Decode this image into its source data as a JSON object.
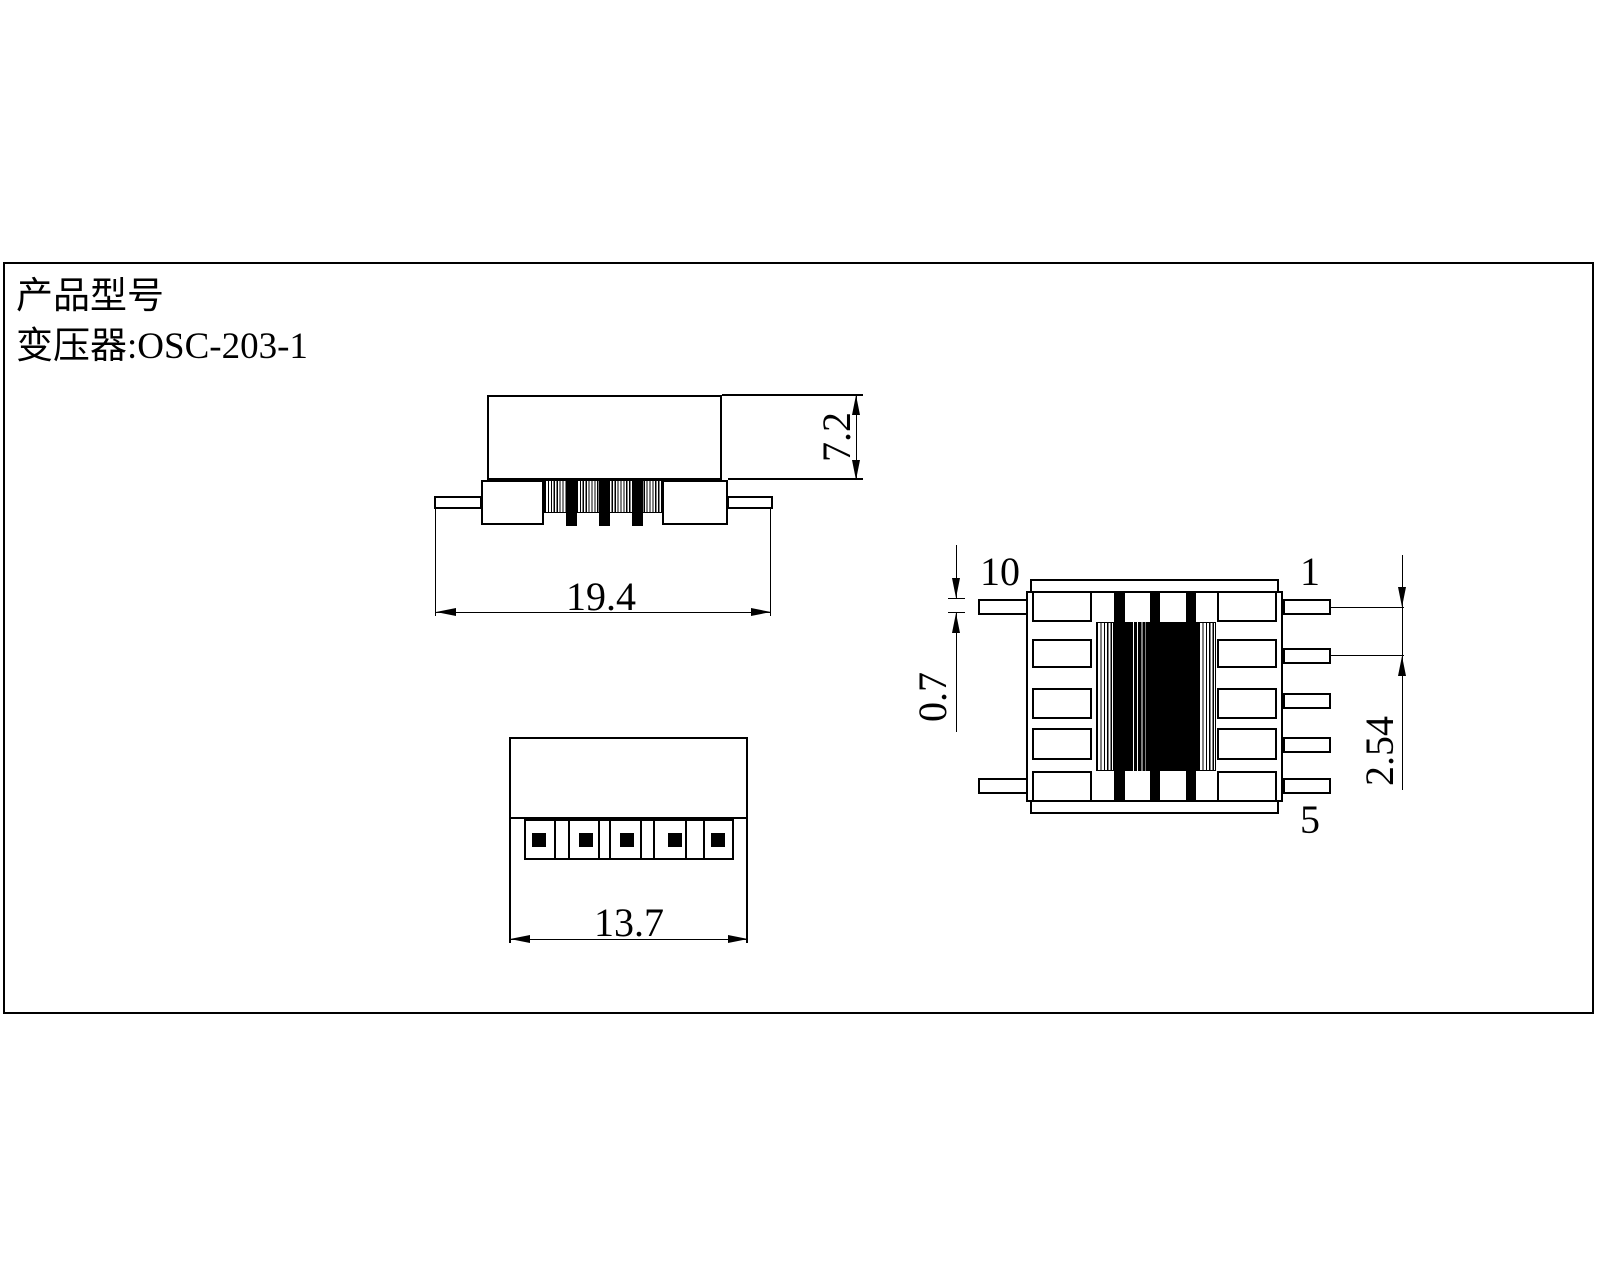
{
  "colors": {
    "ink": "#000000",
    "paper": "#ffffff"
  },
  "title_block": {
    "line1": "产品型号",
    "line2": "变压器:OSC-203-1"
  },
  "front_view": {
    "width_dim": "19.4",
    "height_dim": "7.2"
  },
  "bottom_view": {
    "width_dim": "13.7"
  },
  "side_view": {
    "pin_label_top_left": "10",
    "pin_label_top_right": "1",
    "pin_label_bottom_right": "5",
    "pin_thickness_dim": "0.7",
    "pin_pitch_dim": "2.54"
  }
}
